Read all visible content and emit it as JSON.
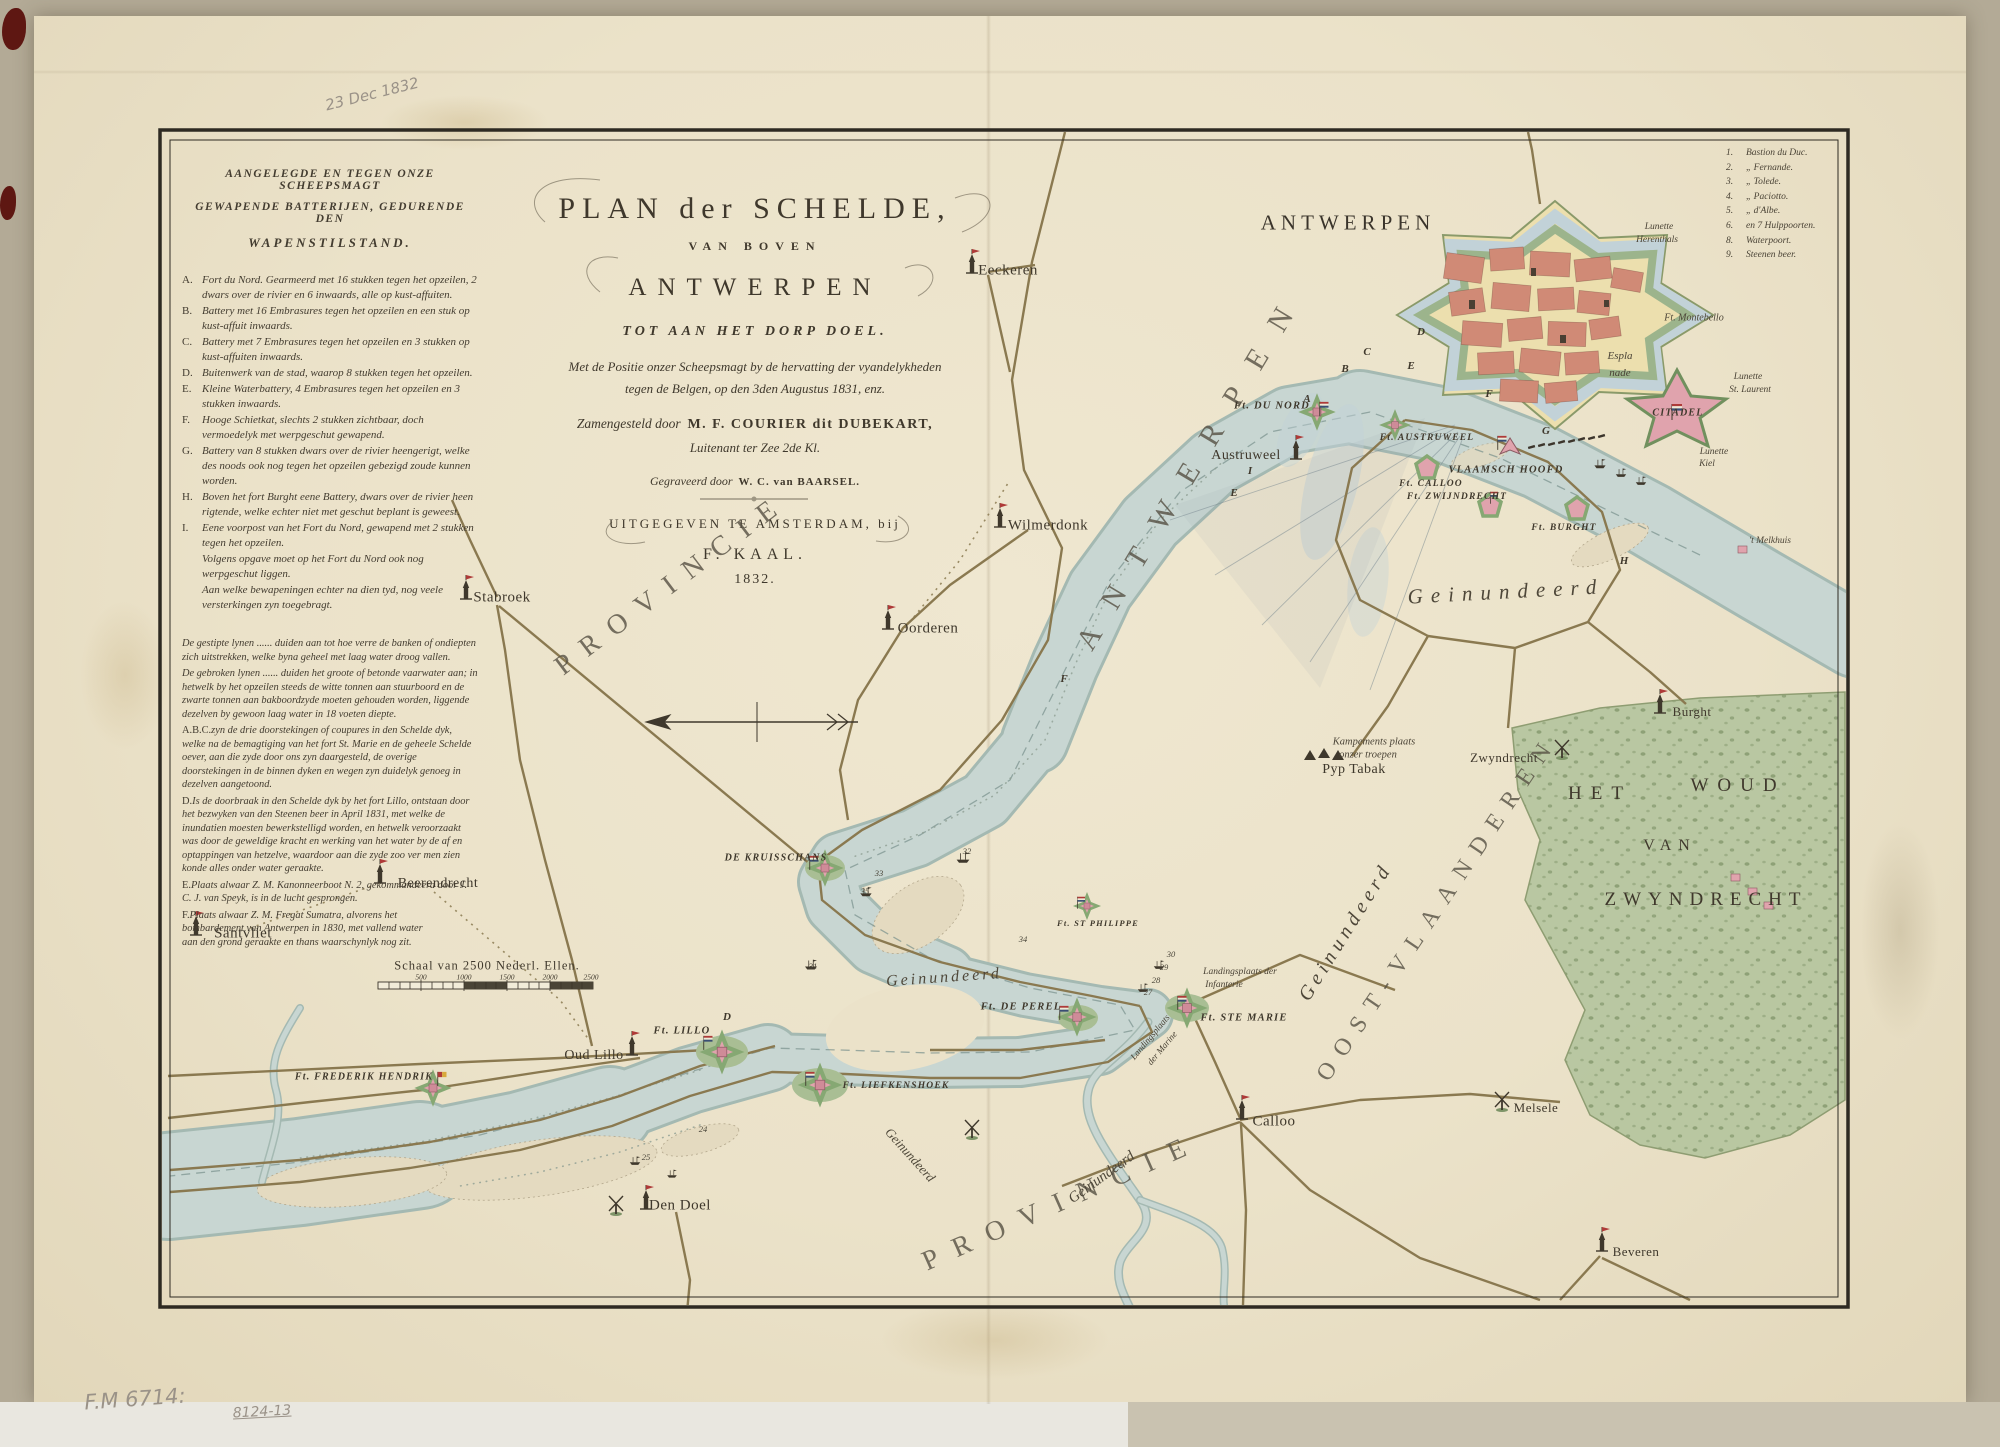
{
  "annotations": {
    "date_note": "23 Dec 1832",
    "shelf_mark": "F.M 6714:",
    "shelf_mark2": "8124-13"
  },
  "title_block": {
    "line1": "PLAN der SCHELDE,",
    "line2": "VAN BOVEN",
    "line3": "ANTWERPEN",
    "line4": "TOT AAN HET DORP DOEL.",
    "line5": "Met de Positie onzer Scheepsmagt by de hervatting der vyandelykheden",
    "line6": "tegen de Belgen, op den 3den Augustus 1831, enz.",
    "line7a": "Zamengesteld door",
    "line7b": "M. F. COURIER dit DUBEKART,",
    "line8": "Luitenant ter Zee 2de Kl.",
    "line9a": "Gegraveerd door",
    "line9b": "W. C. van BAARSEL.",
    "line10": "UITGEGEVEN TE AMSTERDAM, bij",
    "line11": "F. KAAL.",
    "line12": "1832."
  },
  "legend_batteries": {
    "heading1": "AANGELEGDE EN TEGEN ONZE SCHEEPSMAGT",
    "heading2": "GEWAPENDE BATTERIJEN, GEDURENDE DEN",
    "heading3": "WAPENSTILSTAND.",
    "items": [
      {
        "k": "A.",
        "t": "Fort du Nord. Gearmeerd met 16 stukken tegen het opzeilen, 2 dwars over de rivier en 6 inwaards, alle op kust-affuiten."
      },
      {
        "k": "B.",
        "t": "Battery met 16 Embrasures tegen het opzeilen en een stuk op kust-affuit inwaards."
      },
      {
        "k": "C.",
        "t": "Battery met 7 Embrasures tegen het opzeilen en 3 stukken op kust-affuiten inwaards."
      },
      {
        "k": "D.",
        "t": "Buitenwerk van de stad, waarop 8 stukken tegen het opzeilen."
      },
      {
        "k": "E.",
        "t": "Kleine Waterbattery, 4 Embrasures tegen het opzeilen en 3 stukken inwaards."
      },
      {
        "k": "F.",
        "t": "Hooge Schietkat, slechts 2 stukken zichtbaar, doch vermoedelyk met werpgeschut gewapend."
      },
      {
        "k": "G.",
        "t": "Battery van 8 stukken dwars over de rivier heengerigt, welke des noods ook nog tegen het opzeilen gebezigd zoude kunnen worden."
      },
      {
        "k": "H.",
        "t": "Boven het fort Burght eene Battery, dwars over de rivier heen rigtende, welke echter niet met geschut beplant is geweest."
      },
      {
        "k": "I.",
        "t": "Eene voorpost van het Fort du Nord, gewapend met 2 stukken tegen het opzeilen."
      },
      {
        "k": "",
        "t": "Volgens opgave moet op het Fort du Nord ook nog werpgeschut liggen."
      },
      {
        "k": "",
        "t": "Aan welke bewapeningen echter na dien tyd, nog veele versterkingen zyn toegebragt."
      }
    ],
    "notes": [
      {
        "k": "",
        "t": "De gestipte lynen ...... duiden aan tot hoe verre de banken of ondiepten zich uitstrekken, welke byna geheel met laag water droog vallen."
      },
      {
        "k": "",
        "t": "De gebroken lynen ...... duiden het groote of betonde vaarwater aan; in hetwelk by het opzeilen steeds de witte tonnen aan stuurboord en de zwarte tonnen aan bakboordzyde moeten gehouden worden, liggende dezelven by gewoon laag water in 18 voeten diepte."
      },
      {
        "k": "A.B.C.",
        "t": "zyn de drie doorstekingen of coupures in den Schelde dyk, welke na de bemagtiging van het fort St. Marie en de geheele Schelde oever, aan die zyde door ons zyn daargesteld, de overige doorstekingen in de binnen dyken en wegen zyn duidelyk genoeg in dezelven aangetoond."
      },
      {
        "k": "D.",
        "t": "Is de doorbraak in den Schelde dyk by het fort Lillo, ontstaan door het bezwyken van den Steenen beer in April 1831, met welke de inundatien moesten bewerkstelligd worden, en hetwelk veroorzaakt was door de geweldige kracht en werking van het water by de af en optappingen van hetzelve, waardoor aan die zyde zoo ver men zien konde alles onder water geraakte."
      },
      {
        "k": "E.",
        "t": "Plaats alwaar Z. M. Kanonneerboot N. 2, gekommandeerd door J. C. J. van Speyk, is in de lucht gesprongen."
      },
      {
        "k": "F.",
        "t": "Plaats alwaar Z. M. Fregat Sumatra, alvorens het bombardement van Antwerpen in 1830, met vallend water aan den grond geraakte en thans waarschynlyk nog zit."
      }
    ]
  },
  "legend_bastions": {
    "items": [
      {
        "n": "1.",
        "name": "Bastion du Duc."
      },
      {
        "n": "2.",
        "name": "„  Fernande."
      },
      {
        "n": "3.",
        "name": "„  Tolede."
      },
      {
        "n": "4.",
        "name": "„  Paciotto."
      },
      {
        "n": "5.",
        "name": "„  d'Albe."
      },
      {
        "n": "6.",
        "name": "en 7 Hulppoorten."
      },
      {
        "n": "8.",
        "name": "Waterpoort."
      },
      {
        "n": "9.",
        "name": "Steenen beer."
      }
    ]
  },
  "map": {
    "colors": {
      "paper": "#ebe2c9",
      "river": "#c8d6d2",
      "riveredge": "#a4b9b2",
      "moat": "#c2d2d8",
      "woods": "#b7c6a0",
      "woodsdot": "#7e9468",
      "city": "#d08a76",
      "fortpink": "#e0a3ad",
      "green": "#86a873",
      "dyke": "#8a7950",
      "ink": "#3f382c",
      "red": "#ae3a38",
      "blue": "#3a4e74",
      "sand": "#e4dac0",
      "yellow": "#ecdfae"
    },
    "labels": [
      {
        "t": "ANTWERPEN",
        "x": 1348,
        "y": 223,
        "c": "cityT",
        "ls": 5
      },
      {
        "t": "ANTWERPEN",
        "x": 1192,
        "y": 468,
        "c": "prov",
        "r": -59
      },
      {
        "t": "PROVINCIE",
        "x": 672,
        "y": 584,
        "c": "prov2",
        "r": -37
      },
      {
        "t": "PROVINCIE",
        "x": 1062,
        "y": 1202,
        "c": "prov2",
        "r": -24,
        "ls": 17
      },
      {
        "t": "OOST-VLAANDEREN",
        "x": 1438,
        "y": 908,
        "c": "prov2",
        "r": -56,
        "s": 24,
        "ls": 12
      },
      {
        "t": "HET",
        "x": 1600,
        "y": 794,
        "c": "place",
        "s": 19,
        "ls": 9
      },
      {
        "t": "WOUD",
        "x": 1738,
        "y": 786,
        "c": "place",
        "s": 19,
        "ls": 9
      },
      {
        "t": "VAN",
        "x": 1670,
        "y": 846,
        "c": "place",
        "s": 16,
        "ls": 7
      },
      {
        "t": "ZWYNDRECHT",
        "x": 1706,
        "y": 900,
        "c": "place",
        "s": 19,
        "ls": 7
      },
      {
        "t": "Geinundeerd",
        "x": 1506,
        "y": 592,
        "c": "cur",
        "s": 21,
        "ls": 8,
        "r": -3
      },
      {
        "t": "Geinundeerd",
        "x": 944,
        "y": 978,
        "c": "cur",
        "s": 16,
        "ls": 3,
        "r": -4
      },
      {
        "t": "Geinundeerd",
        "x": 910,
        "y": 1155,
        "c": "cur",
        "s": 13,
        "r": 48
      },
      {
        "t": "Geinundeerd",
        "x": 1102,
        "y": 1178,
        "c": "cur",
        "s": 15,
        "r": -36
      },
      {
        "t": "Geinundeerd",
        "x": 1346,
        "y": 932,
        "c": "cur",
        "s": 20,
        "ls": 5,
        "r": -58
      },
      {
        "t": "Eeckeren",
        "x": 1008,
        "y": 271
      },
      {
        "t": "Wilmerdonk",
        "x": 1048,
        "y": 526
      },
      {
        "t": "Oorderen",
        "x": 928,
        "y": 629
      },
      {
        "t": "Stabroek",
        "x": 502,
        "y": 598
      },
      {
        "t": "Austruweel",
        "x": 1246,
        "y": 456,
        "s": 14
      },
      {
        "t": "Beerendrecht",
        "x": 438,
        "y": 884,
        "s": 14
      },
      {
        "t": "Santvliet",
        "x": 243,
        "y": 934
      },
      {
        "t": "Oud Lillo",
        "x": 594,
        "y": 1056,
        "s": 14
      },
      {
        "t": "Den Doel",
        "x": 680,
        "y": 1206
      },
      {
        "t": "Calloo",
        "x": 1274,
        "y": 1122
      },
      {
        "t": "Melsele",
        "x": 1536,
        "y": 1108,
        "s": 13
      },
      {
        "t": "Beveren",
        "x": 1636,
        "y": 1252,
        "s": 13
      },
      {
        "t": "Burght",
        "x": 1692,
        "y": 712,
        "s": 13
      },
      {
        "t": "Zwyndrecht",
        "x": 1504,
        "y": 758,
        "s": 13
      },
      {
        "t": "Pyp Tabak",
        "x": 1354,
        "y": 770,
        "s": 14
      },
      {
        "t": "Ft. DU NORD",
        "x": 1272,
        "y": 406,
        "c": "fort"
      },
      {
        "t": "Ft. AUSTRUWEEL",
        "x": 1427,
        "y": 438,
        "c": "fort",
        "s": 9.5
      },
      {
        "t": "VLAAMSCH HOOFD",
        "x": 1506,
        "y": 470,
        "c": "fort",
        "s": 10.5
      },
      {
        "t": "Ft. CALLOO",
        "x": 1431,
        "y": 484,
        "c": "fort",
        "s": 9.5
      },
      {
        "t": "Ft. ZWIJNDRECHT",
        "x": 1457,
        "y": 497,
        "c": "fort",
        "s": 9.5
      },
      {
        "t": "Ft. BURGHT",
        "x": 1564,
        "y": 528,
        "c": "fort",
        "s": 9.5
      },
      {
        "t": "CITADEL",
        "x": 1678,
        "y": 413,
        "c": "fort",
        "s": 10
      },
      {
        "t": "Ft. STE MARIE",
        "x": 1244,
        "y": 1018,
        "c": "fort",
        "s": 10.5
      },
      {
        "t": "Ft. DE PEREL",
        "x": 1021,
        "y": 1007,
        "c": "fort",
        "s": 10.5
      },
      {
        "t": "Ft. ST PHILIPPE",
        "x": 1098,
        "y": 923,
        "c": "fort",
        "s": 8.5
      },
      {
        "t": "DE KRUISSCHANS",
        "x": 776,
        "y": 858,
        "c": "fort",
        "s": 10
      },
      {
        "t": "Ft. LILLO",
        "x": 682,
        "y": 1031,
        "c": "fort",
        "s": 10.5
      },
      {
        "t": "Ft. LIEFKENSHOEK",
        "x": 896,
        "y": 1086,
        "c": "fort",
        "s": 9.5
      },
      {
        "t": "Ft. FREDERIK HENDRIK",
        "x": 364,
        "y": 1077,
        "c": "fort",
        "s": 10
      },
      {
        "t": "Lunette",
        "x": 1659,
        "y": 227,
        "c": "tiny"
      },
      {
        "t": "Herenthals",
        "x": 1657,
        "y": 240,
        "c": "tiny"
      },
      {
        "t": "Ft. Montebello",
        "x": 1694,
        "y": 318,
        "c": "tiny",
        "s": 10
      },
      {
        "t": "Lunette",
        "x": 1748,
        "y": 377,
        "c": "tiny"
      },
      {
        "t": "St. Laurent",
        "x": 1750,
        "y": 390,
        "c": "tiny"
      },
      {
        "t": "Lunette",
        "x": 1714,
        "y": 452,
        "c": "tiny"
      },
      {
        "t": "Kiel",
        "x": 1707,
        "y": 464,
        "c": "tiny"
      },
      {
        "t": "'t Melkhuis",
        "x": 1770,
        "y": 541,
        "c": "tiny"
      },
      {
        "t": "Espla",
        "x": 1620,
        "y": 356,
        "c": "tiny",
        "s": 11
      },
      {
        "t": "nade",
        "x": 1620,
        "y": 373,
        "c": "tiny",
        "s": 11
      },
      {
        "t": "Kampements plaats",
        "x": 1374,
        "y": 742,
        "c": "tiny",
        "s": 10.5
      },
      {
        "t": "onzer troepen",
        "x": 1368,
        "y": 755,
        "c": "tiny",
        "s": 10.5
      },
      {
        "t": "Landingsplaats der",
        "x": 1240,
        "y": 972,
        "c": "tiny"
      },
      {
        "t": "Infanterie",
        "x": 1224,
        "y": 985,
        "c": "tiny"
      },
      {
        "t": "Landingsplaats",
        "x": 1150,
        "y": 1037,
        "c": "tiny",
        "s": 9,
        "r": -50
      },
      {
        "t": "der Marine",
        "x": 1162,
        "y": 1048,
        "c": "tiny",
        "s": 9,
        "r": -50
      },
      {
        "t": "A",
        "x": 1307,
        "y": 399,
        "c": "mk"
      },
      {
        "t": "B",
        "x": 1345,
        "y": 369,
        "c": "mk"
      },
      {
        "t": "C",
        "x": 1367,
        "y": 352,
        "c": "mk"
      },
      {
        "t": "D",
        "x": 1421,
        "y": 332,
        "c": "mk"
      },
      {
        "t": "E",
        "x": 1411,
        "y": 366,
        "c": "mk"
      },
      {
        "t": "F",
        "x": 1489,
        "y": 394,
        "c": "mk"
      },
      {
        "t": "G",
        "x": 1546,
        "y": 431,
        "c": "mk"
      },
      {
        "t": "H",
        "x": 1624,
        "y": 561,
        "c": "mk"
      },
      {
        "t": "I",
        "x": 1250,
        "y": 471,
        "c": "mk"
      },
      {
        "t": "D",
        "x": 727,
        "y": 1017,
        "c": "mk"
      },
      {
        "t": "E",
        "x": 1234,
        "y": 493,
        "c": "mk"
      },
      {
        "t": "F",
        "x": 1064,
        "y": 679,
        "c": "mk"
      },
      {
        "t": "32",
        "x": 967,
        "y": 851,
        "c": "num"
      },
      {
        "t": "33",
        "x": 879,
        "y": 873,
        "c": "num"
      },
      {
        "t": "35",
        "x": 865,
        "y": 891,
        "c": "num"
      },
      {
        "t": "31",
        "x": 813,
        "y": 966,
        "c": "num"
      },
      {
        "t": "34",
        "x": 1023,
        "y": 939,
        "c": "num"
      },
      {
        "t": "30",
        "x": 1171,
        "y": 954,
        "c": "num"
      },
      {
        "t": "29",
        "x": 1164,
        "y": 967,
        "c": "num"
      },
      {
        "t": "28",
        "x": 1156,
        "y": 980,
        "c": "num"
      },
      {
        "t": "27",
        "x": 1148,
        "y": 992,
        "c": "num"
      },
      {
        "t": "25",
        "x": 646,
        "y": 1157,
        "c": "num"
      },
      {
        "t": "24",
        "x": 703,
        "y": 1129,
        "c": "num"
      },
      {
        "t": "Schaal van 2500 Nederl. Ellen.",
        "x": 487,
        "y": 966,
        "c": "sc"
      },
      {
        "t": "500",
        "x": 421,
        "y": 977,
        "c": "scn"
      },
      {
        "t": "1000",
        "x": 464,
        "y": 977,
        "c": "scn"
      },
      {
        "t": "1500",
        "x": 507,
        "y": 977,
        "c": "scn"
      },
      {
        "t": "2000",
        "x": 550,
        "y": 977,
        "c": "scn"
      },
      {
        "t": "2500",
        "x": 591,
        "y": 977,
        "c": "scn"
      }
    ]
  }
}
